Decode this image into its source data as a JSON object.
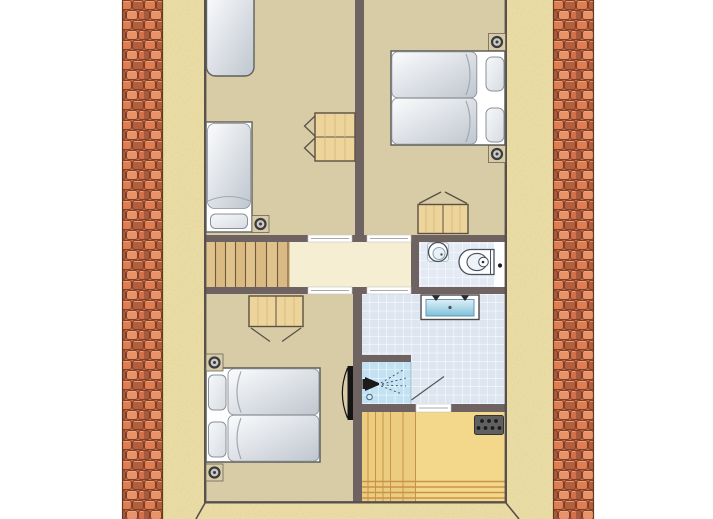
{
  "palette": {
    "background": "#ffffff",
    "wall": "#6e6361",
    "outline": "#57504d",
    "floor": "#d7cca6",
    "landing_floor": "#f5eed3",
    "stairs_wood": "#e0c28c",
    "cabinet_wood": "#ecd49b",
    "hall_wood_floor": "#f3d88b",
    "hall_wood_stripe": "#c9924a",
    "bathroom_tile": "#dde5f1",
    "wc_tile": "#e3eaf4",
    "shower_tile": "#c2e1f2",
    "stucco_sand": "#e9dca4",
    "roof_tile_base": "#c96a43",
    "roof_tile_light": "#e8936a",
    "roof_tile_dark": "#a85a3d",
    "bed_linen": "#c3c9d2",
    "fixture_dark": "#151515"
  },
  "rooms": {
    "bedroom_top_left": {
      "fixtures": [
        "single-bed",
        "single-bed",
        "wall-light",
        "bedside-cabinet"
      ]
    },
    "bedroom_top_right": {
      "fixtures": [
        "double-bed",
        "wall-light",
        "wall-light",
        "wardrobe"
      ]
    },
    "landing": {
      "fixtures": [
        "staircase"
      ]
    },
    "wc": {
      "fixtures": [
        "hand-basin",
        "toilet"
      ]
    },
    "bathroom": {
      "fixtures": [
        "double-washbasin",
        "shower",
        "door-swing"
      ]
    },
    "bedroom_bottom_left": {
      "fixtures": [
        "double-bed",
        "wall-light",
        "wall-light",
        "wardrobe",
        "radiator"
      ]
    },
    "hall": {
      "fixtures": [
        "vent-grille"
      ]
    }
  }
}
